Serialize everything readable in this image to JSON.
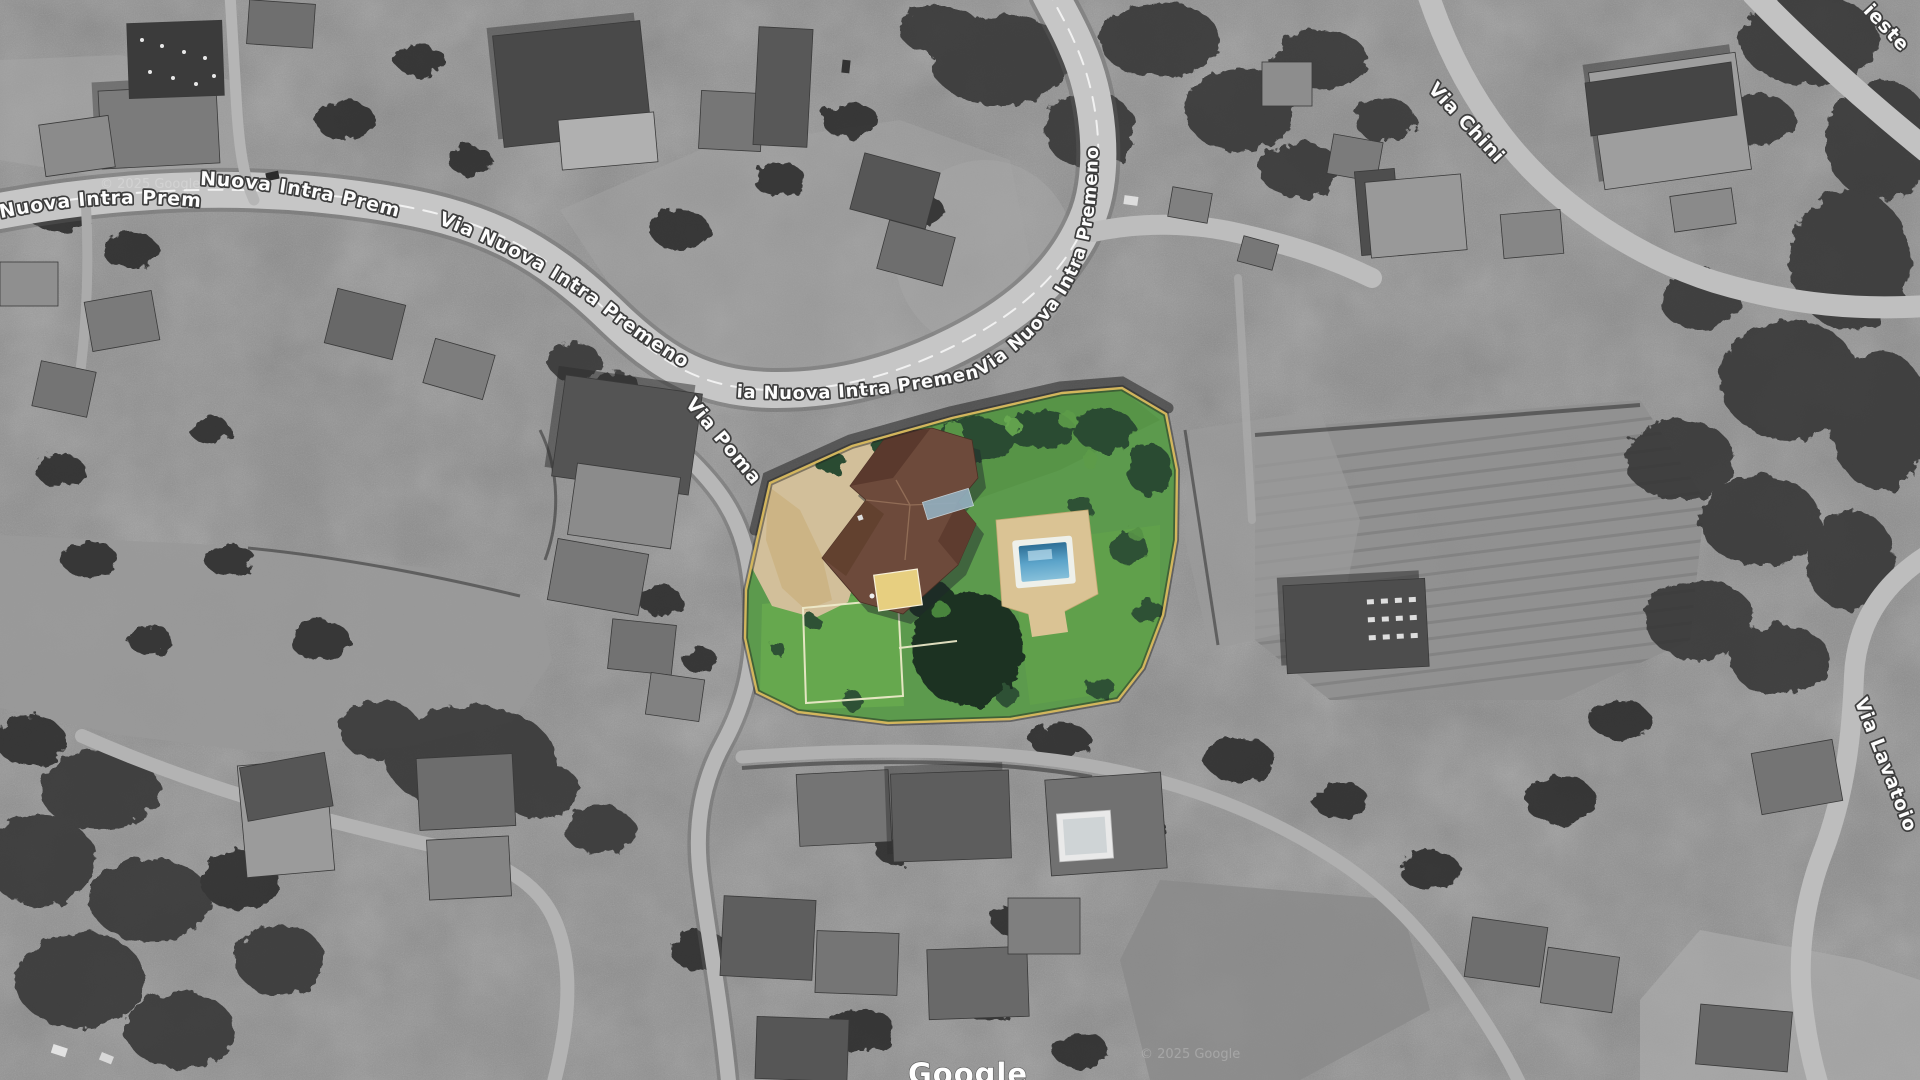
{
  "map": {
    "imagery_style": "grayscale satellite photo with one color-highlighted property parcel",
    "roads": {
      "via_nuova": "Via Nuova Intra Premeno",
      "via_poma": "Via Poma",
      "via_chini": "Via Chini",
      "via_lavatoio": "Via Lavatoio",
      "via_trieste_partial": "ieste"
    },
    "watermark": {
      "logo": "Google",
      "copyright_notice": "© 2025 Google"
    },
    "highlighted_parcel": {
      "description": "villa with garden, driveway and swimming pool",
      "lawn_color": "#5c9a4d",
      "roof_color": "#6d4a3b",
      "pool_water_color": "#4a90b8",
      "driveway_color": "#d2bf9a",
      "boundary_color": "#d9ba5e"
    }
  }
}
